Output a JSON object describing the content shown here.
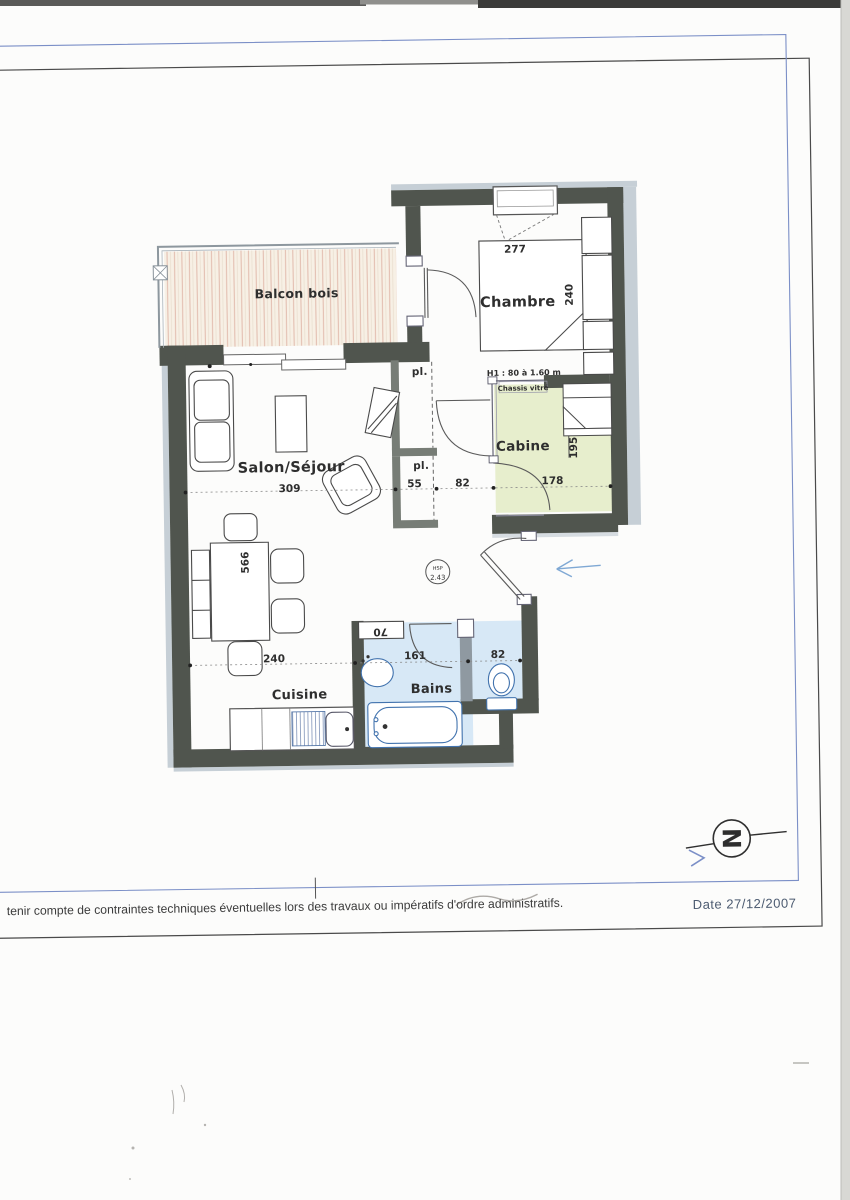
{
  "plan": {
    "rooms": {
      "balcony": "Balcon bois",
      "bedroom": "Chambre",
      "living": "Salon/Séjour",
      "cabin": "Cabine",
      "kitchen": "Cuisine",
      "bath": "Bains"
    },
    "closet_label": "pl.",
    "dims": {
      "bedroom_width": "277",
      "bedroom_depth": "240",
      "living_width": "309",
      "closet_width": "55",
      "hall_width": "82",
      "cabin_width": "178",
      "cabin_depth": "195",
      "living_length": "566",
      "kitchen_width": "240",
      "bath_width": "161",
      "wc_width": "82",
      "appliance_width": "70"
    },
    "notes": {
      "height_note": "H1 : 80 à 1.60 m",
      "glazing_note": "Chassis vitré",
      "ceiling_label": "HSP",
      "ceiling_value": "2.43"
    }
  },
  "footer": {
    "disclaimer": "tenir compte de contraintes techniques éventuelles lors des travaux ou impératifs d'ordre administratifs.",
    "date": "Date 27/12/2007"
  },
  "compass": {
    "north_letter": "N"
  },
  "colors": {
    "wall": "#50554e",
    "closet_wall": "#777d76",
    "cabin_fill": "#e7eecd",
    "bath_fill": "#d7e8f6",
    "frame_blue": "#7b8fc7",
    "frame_black": "#4a4a4a",
    "fixture_blue": "#4273ae",
    "arrow_blue": "#7fa8d4"
  }
}
